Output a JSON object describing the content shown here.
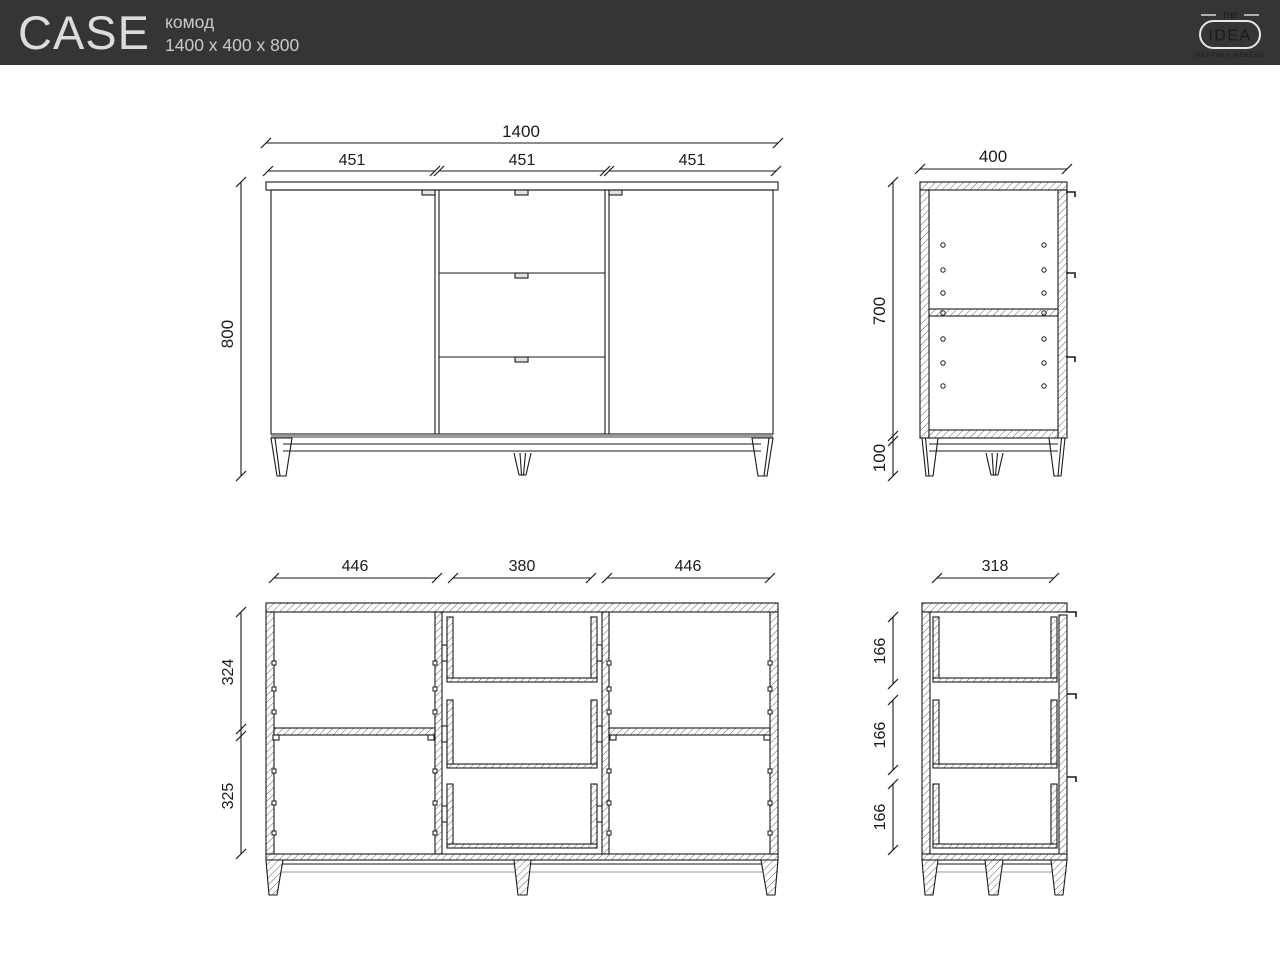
{
  "header": {
    "title": "CASE",
    "product_type": "комод",
    "dimensions": "1400 x 400 x 800",
    "logo": {
      "top": "THE",
      "name": "IDEA",
      "tagline": "ФАБРИКА МЕБЕЛИ"
    }
  },
  "colors": {
    "header_bg": "#353535",
    "header_text": "#dcdcdc",
    "line": "#1a1a1a",
    "hatch": "#555555"
  },
  "views": {
    "front": {
      "total_width": "1400",
      "sections": [
        "451",
        "451",
        "451"
      ],
      "total_height": "800"
    },
    "side": {
      "depth": "400",
      "body_height": "700",
      "leg_height": "100"
    },
    "front_section": {
      "inner_widths": [
        "446",
        "380",
        "446"
      ],
      "upper_height": "324",
      "lower_height": "325"
    },
    "side_section": {
      "inner_depth": "318",
      "drawer_heights": [
        "166",
        "166",
        "166"
      ]
    }
  }
}
